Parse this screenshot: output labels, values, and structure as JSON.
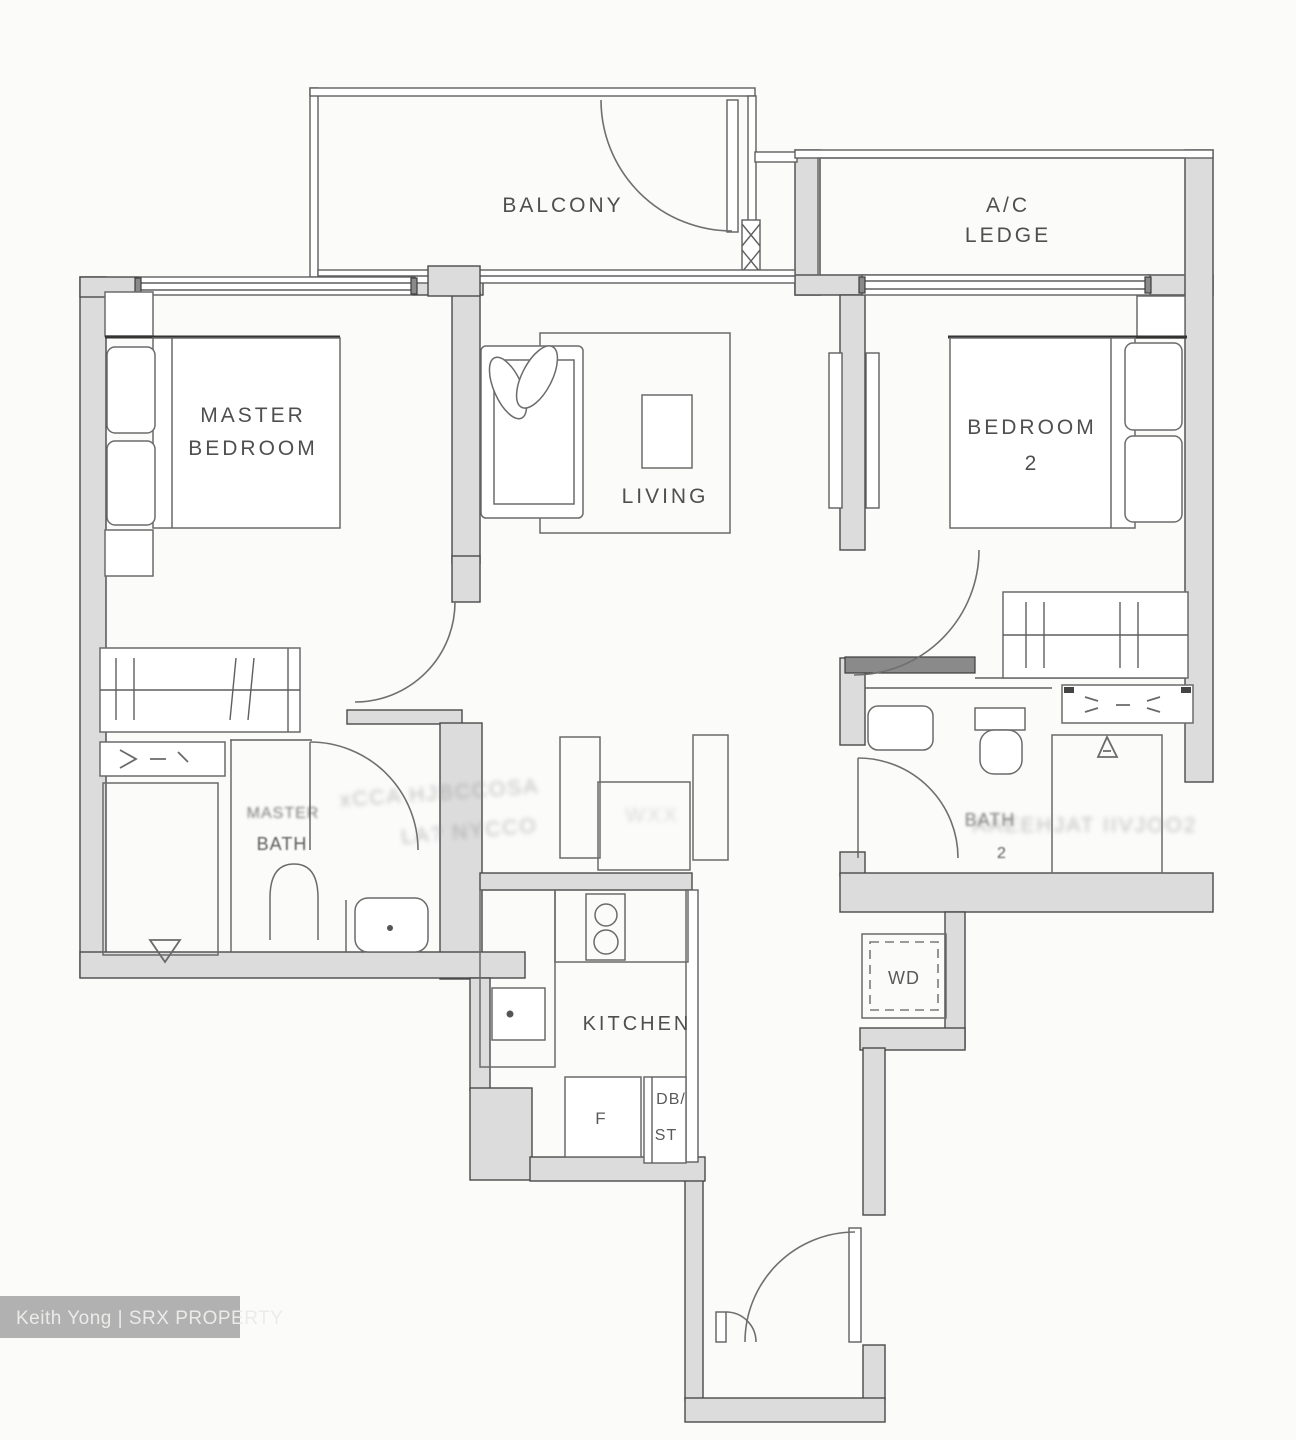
{
  "meta": {
    "width": 1296,
    "height": 1440,
    "background": "#fbfbfa"
  },
  "colors": {
    "wall_fill": "#dcdcdc",
    "wall_edge": "#4a4a4a",
    "thin_line": "#5f5f5f",
    "label_text": "#4f4f4f",
    "watermark_bg": "#b1b1b1",
    "watermark_text": "#ebebe9"
  },
  "labels": {
    "balcony": "BALCONY",
    "ac_ledge_1": "A/C",
    "ac_ledge_2": "LEDGE",
    "master_bedroom_1": "MASTER",
    "master_bedroom_2": "BEDROOM",
    "living": "LIVING",
    "bedroom2_1": "BEDROOM",
    "bedroom2_2": "2",
    "master_bath_1": "MASTER",
    "master_bath_2": "BATH",
    "bath2_1": "BATH",
    "bath2_2": "2",
    "kitchen": "KITCHEN",
    "washer_dryer": "WD",
    "fridge": "F",
    "db_store_1": "DB/",
    "db_store_2": "ST"
  },
  "illegible_smudges": {
    "left_1": "xCCA HJBCCOSA",
    "left_2": "LA? NYCCO",
    "mid": "WXX",
    "right": "AAEEHJAT IIVJOO2"
  },
  "watermark": {
    "text": "Keith Yong | SRX PROPERTY"
  }
}
